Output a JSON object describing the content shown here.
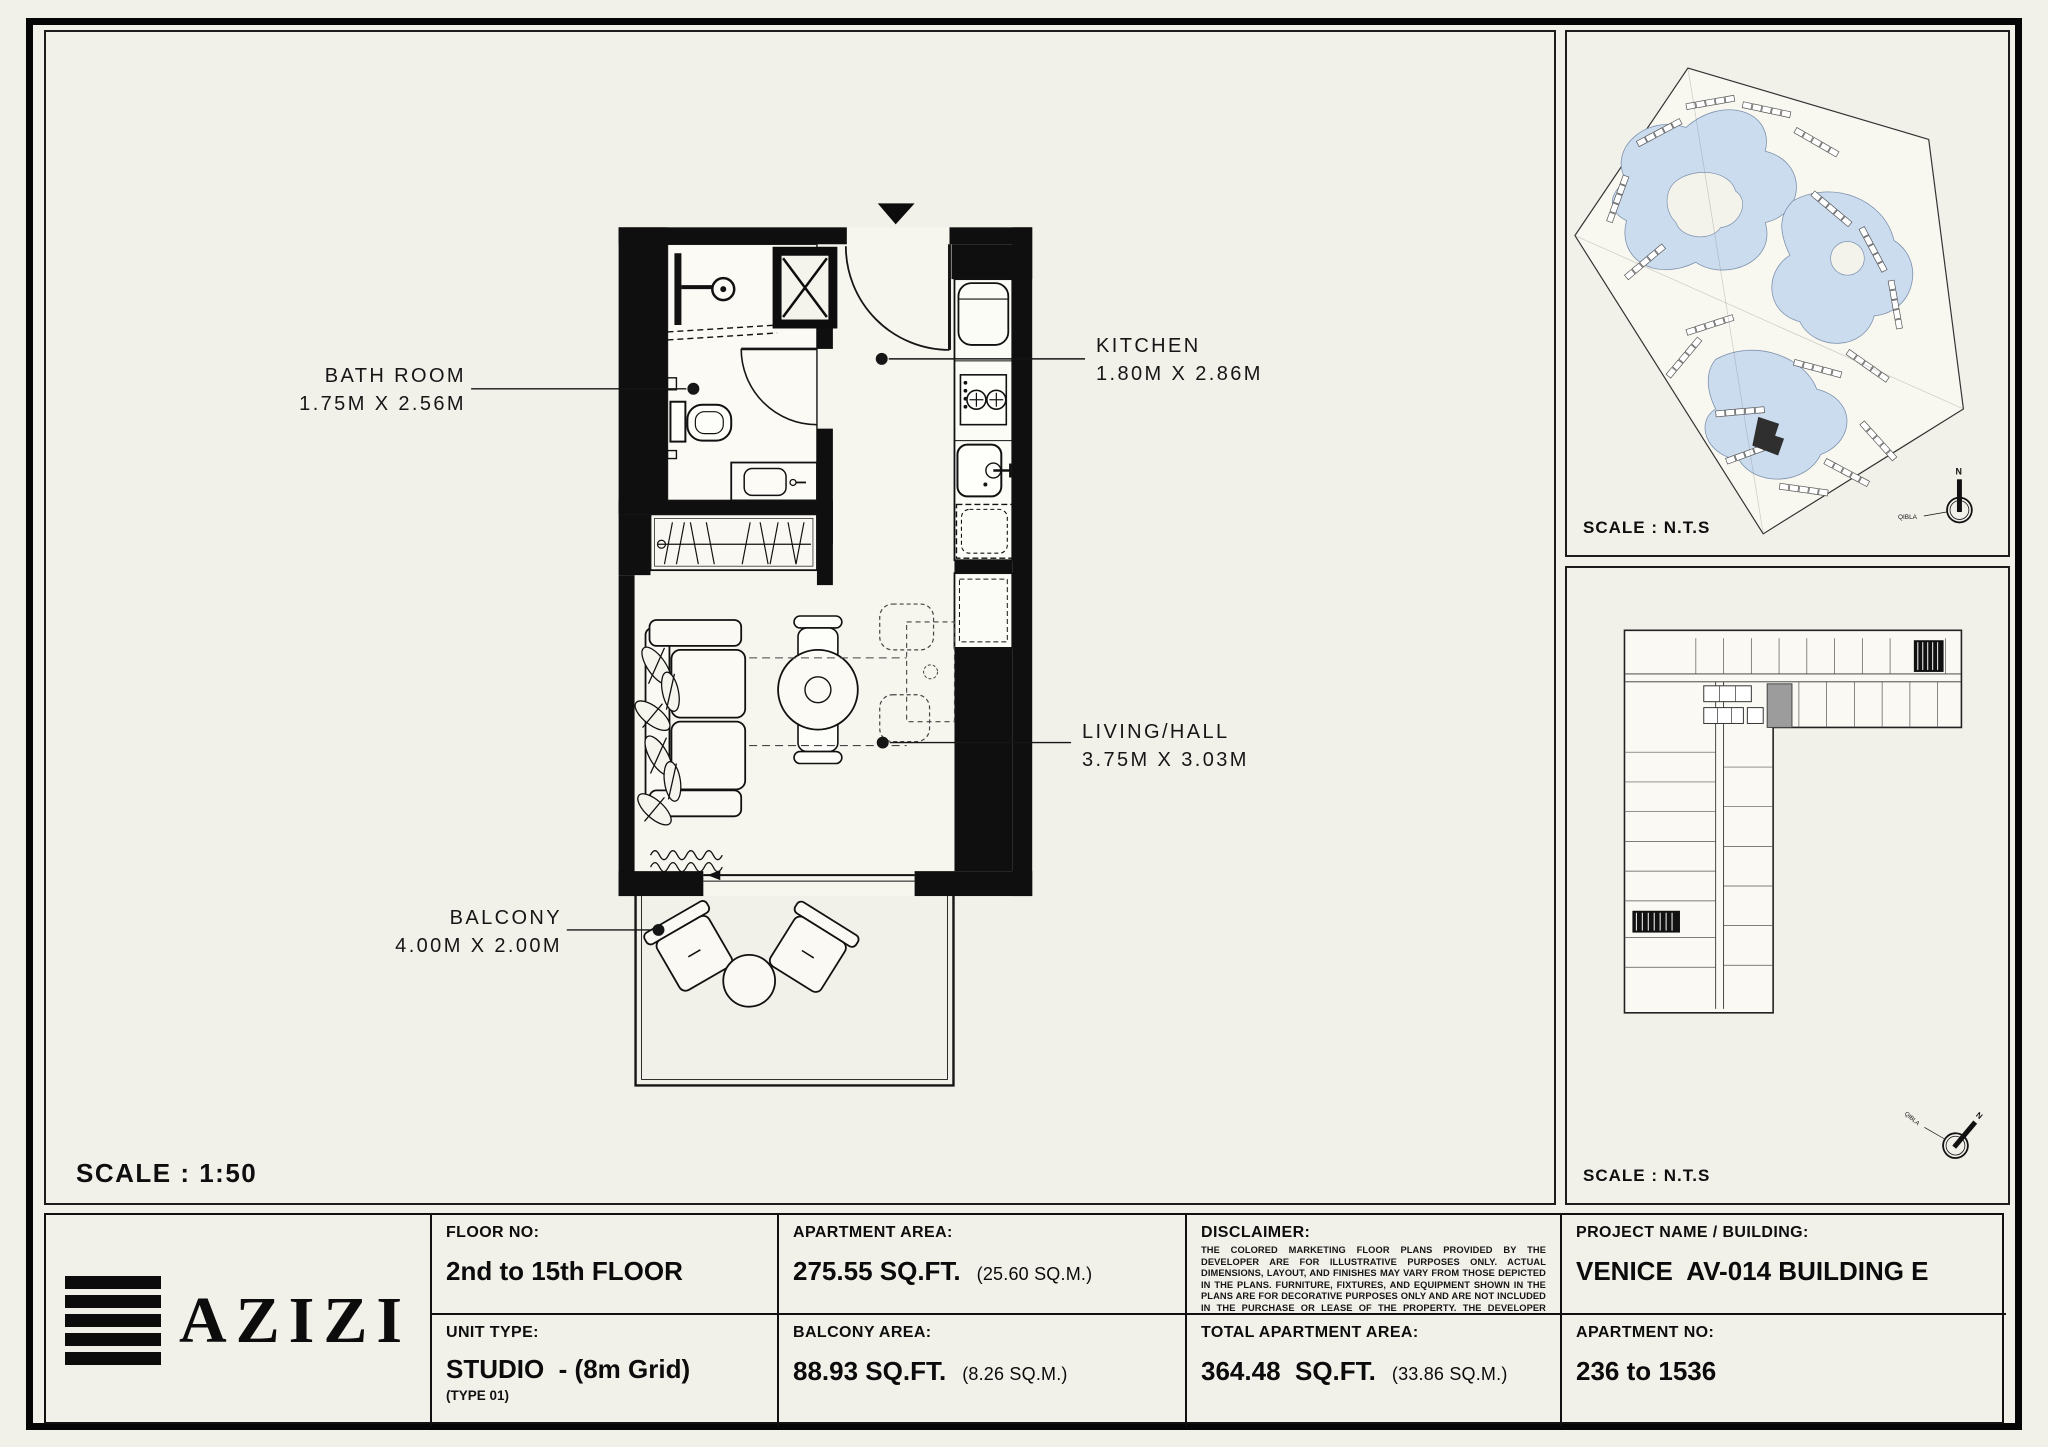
{
  "colors": {
    "paper": "#f1f0e9",
    "ink": "#111111",
    "water": "#cbdcef",
    "unit_highlight": "#9c9c9c"
  },
  "main_panel": {
    "scale_label": "SCALE : 1:50",
    "rooms": {
      "bathroom": {
        "name": "BATH ROOM",
        "dims": "1.75M X 2.56M"
      },
      "kitchen": {
        "name": "KITCHEN",
        "dims": "1.80M X 2.86M"
      },
      "living": {
        "name": "LIVING/HALL",
        "dims": "3.75M X 3.03M"
      },
      "balcony": {
        "name": "BALCONY",
        "dims": "4.00M X 2.00M"
      }
    }
  },
  "site_plan": {
    "scale_label": "SCALE : N.T.S",
    "compass_north": "N",
    "compass_qibla": "QIBLA"
  },
  "key_plan": {
    "scale_label": "SCALE : N.T.S",
    "compass_north": "N",
    "compass_qibla": "QIBLA"
  },
  "title_block": {
    "brand": "AZIZI",
    "floor": {
      "label": "FLOOR NO:",
      "value": "2nd to 15th FLOOR"
    },
    "unit_type": {
      "label": "UNIT TYPE:",
      "value": "STUDIO  - (8m Grid)",
      "sub": "(TYPE 01)"
    },
    "apartment_area": {
      "label": "APARTMENT AREA:",
      "value": "275.55 SQ.FT.",
      "metric": "(25.60 SQ.M.)"
    },
    "balcony_area": {
      "label": "BALCONY AREA:",
      "value": "88.93 SQ.FT.",
      "metric": "(8.26 SQ.M.)"
    },
    "disclaimer": {
      "label": "DISCLAIMER:",
      "text": "THE COLORED MARKETING FLOOR PLANS PROVIDED BY THE DEVELOPER ARE FOR ILLUSTRATIVE PURPOSES ONLY. ACTUAL DIMENSIONS, LAYOUT, AND FINISHES MAY VARY FROM THOSE DEPICTED IN THE PLANS. FURNITURE, FIXTURES, AND EQUIPMENT SHOWN IN THE PLANS ARE FOR DECORATIVE PURPOSES ONLY AND ARE NOT INCLUDED IN THE PURCHASE OR LEASE OF THE PROPERTY. THE DEVELOPER RESERVES THE RIGHT TO MAKE MODIFICATIONS, REVISIONS, AND CHANGES TO THE FLOOR PLANS, SPECIFICATIONS, AND FEATURES WITHOUT PRIOR NOTICE."
    },
    "total_area": {
      "label": "TOTAL APARTMENT AREA:",
      "value": "364.48  SQ.FT.",
      "metric": "(33.86 SQ.M.)"
    },
    "project": {
      "label": "PROJECT NAME / BUILDING:",
      "value": "VENICE  AV-014 BUILDING E"
    },
    "apartment_no": {
      "label": "APARTMENT NO:",
      "value": "236 to 1536"
    }
  }
}
